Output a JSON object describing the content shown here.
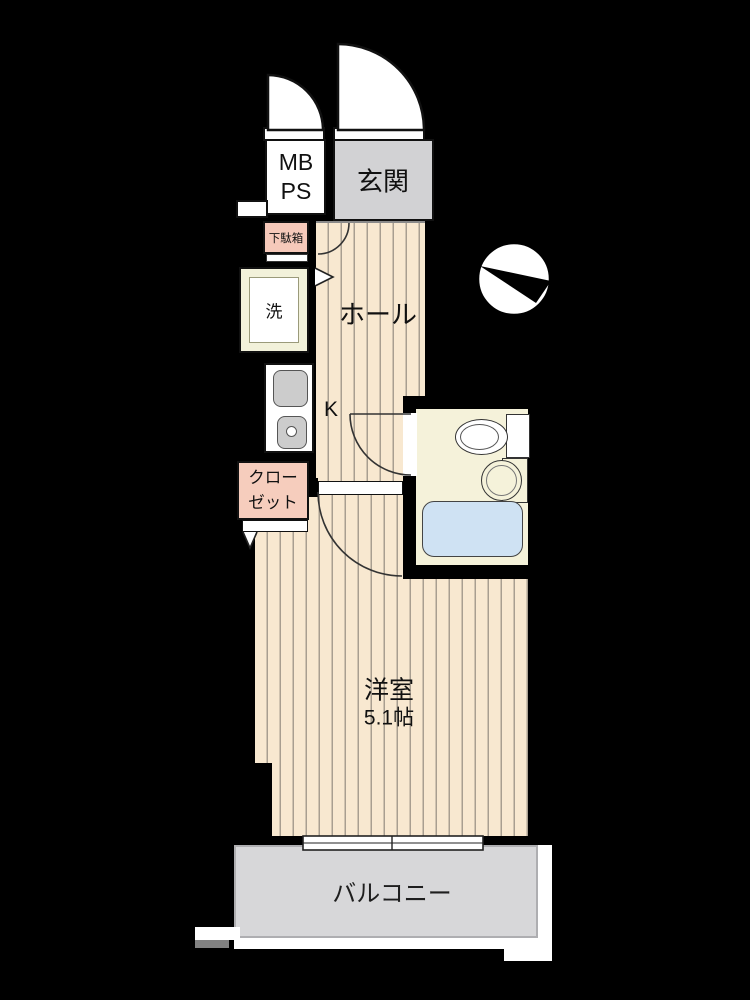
{
  "floorplan": {
    "type": "japanese-apartment-1k-floorplan",
    "rooms": {
      "mb_ps": {
        "line1": "MB",
        "line2": "PS"
      },
      "entrance": {
        "label": "玄関"
      },
      "shoe_cabinet": {
        "label": "下駄箱"
      },
      "laundry": {
        "label": "洗"
      },
      "hall": {
        "label": "ホール"
      },
      "kitchen": {
        "label": "K"
      },
      "closet": {
        "line1": "クロー",
        "line2": "ゼット"
      },
      "western_room": {
        "label": "洋室",
        "size": "5.1帖"
      },
      "balcony": {
        "label": "バルコニー"
      }
    },
    "fixtures": [
      "toilet",
      "sink",
      "bathtub",
      "kitchen-sink",
      "stove",
      "washing-machine-space",
      "shoe-cabinet",
      "closet"
    ],
    "symbols": {
      "compass": "north-arrow in circle pointing upper-left",
      "doors": [
        "entrance-swing-door",
        "mbps-swing-door",
        "hall-swing-door",
        "bathroom-swing-door",
        "room-swing-door",
        "closet-folding-door",
        "balcony-sliding-window"
      ]
    },
    "colors": {
      "wall": "#000000",
      "flooring": "#f8e8d0",
      "flooring_stripe": "#a89e90",
      "entrance_fill": "#d2d2d4",
      "balcony_fill": "#d7d7d9",
      "closet_fill": "#f6cdbd",
      "shoe_cabinet_fill": "#f6c9ba",
      "bathroom_fill": "#f5f2da",
      "bathtub_fill": "#cfe2f3",
      "fixture_gray": "#cbcbcb",
      "laundry_fill": "#f2f1da"
    }
  }
}
